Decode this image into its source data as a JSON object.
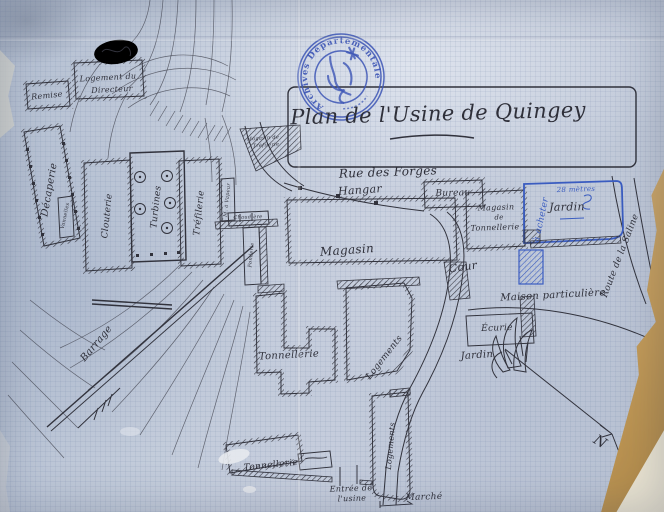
{
  "stamp": {
    "text": "Archives Départementales",
    "color": "#3c55b5"
  },
  "palette": {
    "paper": "#bfc8d7",
    "ink": "#31323c",
    "blue_ink": "#3a5cc0",
    "stamp_blue": "#3c55b5",
    "tear_tan": "#c9a567",
    "fold_cream": "#e9e3d1"
  },
  "labels": [
    {
      "n": "map-title",
      "t": "Plan de l'Usine de Quingey",
      "x": 438,
      "y": 114,
      "r": -1.5,
      "s": 21
    },
    {
      "n": "label-rue-des-forges",
      "t": "Rue des Forges",
      "x": 388,
      "y": 172,
      "r": -2,
      "s": 12
    },
    {
      "n": "label-hangar",
      "t": "Hangar",
      "x": 360,
      "y": 190,
      "r": -4,
      "s": 11
    },
    {
      "n": "label-bureau",
      "t": "Bureau",
      "x": 453,
      "y": 194,
      "r": -1,
      "s": 9
    },
    {
      "n": "label-magasin-tonnellerie-1",
      "t": "Magasin",
      "x": 496,
      "y": 208,
      "r": -2,
      "s": 8
    },
    {
      "n": "label-magasin-tonnellerie-2",
      "t": "de",
      "x": 499,
      "y": 218,
      "r": -2,
      "s": 7
    },
    {
      "n": "label-magasin-tonnellerie-3",
      "t": "Tonnellerie",
      "x": 495,
      "y": 228,
      "r": -2,
      "s": 8
    },
    {
      "n": "label-jardin-nord",
      "t": "Jardin",
      "x": 567,
      "y": 207,
      "r": -1,
      "s": 11
    },
    {
      "n": "label-dimension-jardin",
      "t": "28 mètres",
      "x": 576,
      "y": 190,
      "r": -2,
      "s": 7,
      "c": "blue"
    },
    {
      "n": "label-a-acheter",
      "t": "à acheter",
      "x": 542,
      "y": 220,
      "r": -78,
      "s": 9,
      "c": "blue"
    },
    {
      "n": "label-route-de-la-saline",
      "t": "Route de la Saline",
      "x": 621,
      "y": 256,
      "r": -69,
      "s": 9
    },
    {
      "n": "label-maison-particuliere",
      "t": "Maison particulière",
      "x": 553,
      "y": 296,
      "r": -3,
      "s": 10
    },
    {
      "n": "label-cour",
      "t": "Cour",
      "x": 463,
      "y": 267,
      "r": -8,
      "s": 11
    },
    {
      "n": "label-magasin",
      "t": "Magasin",
      "x": 347,
      "y": 250,
      "r": -4,
      "s": 12
    },
    {
      "n": "label-tonnellerie-centre",
      "t": "Tonnellerie",
      "x": 289,
      "y": 356,
      "r": -3,
      "s": 10
    },
    {
      "n": "label-logements-centre",
      "t": "Logements",
      "x": 385,
      "y": 358,
      "r": -52,
      "s": 9
    },
    {
      "n": "label-ecurie",
      "t": "Écurie",
      "x": 497,
      "y": 329,
      "r": -2,
      "s": 9
    },
    {
      "n": "label-jardin-sud",
      "t": "Jardin",
      "x": 477,
      "y": 356,
      "r": -4,
      "s": 10
    },
    {
      "n": "label-nord",
      "t": "N",
      "x": 600,
      "y": 442,
      "r": 32,
      "s": 14
    },
    {
      "n": "label-logements-sud",
      "t": "Logements",
      "x": 391,
      "y": 446,
      "r": -85,
      "s": 8
    },
    {
      "n": "label-tonnellerie-sud",
      "t": "Tonnellerie",
      "x": 271,
      "y": 466,
      "r": -6,
      "s": 9
    },
    {
      "n": "label-entree-usine-1",
      "t": "Entrée de",
      "x": 351,
      "y": 489,
      "r": -2,
      "s": 8
    },
    {
      "n": "label-entree-usine-2",
      "t": "l'usine",
      "x": 352,
      "y": 499,
      "r": -2,
      "s": 8
    },
    {
      "n": "label-marche",
      "t": "Marché",
      "x": 424,
      "y": 498,
      "r": -2,
      "s": 9
    },
    {
      "n": "label-remise",
      "t": "Remise",
      "x": 47,
      "y": 96,
      "r": -6,
      "s": 8
    },
    {
      "n": "label-logement-directeur-1",
      "t": "Logement du",
      "x": 108,
      "y": 78,
      "r": -3,
      "s": 8
    },
    {
      "n": "label-logement-directeur-2",
      "t": "Directeur",
      "x": 112,
      "y": 90,
      "r": -3,
      "s": 8
    },
    {
      "n": "label-decaperie",
      "t": "Décaperie",
      "x": 50,
      "y": 190,
      "r": -80,
      "s": 10
    },
    {
      "n": "label-clouterie",
      "t": "Clouterie",
      "x": 108,
      "y": 216,
      "r": -84,
      "s": 9
    },
    {
      "n": "label-turbines",
      "t": "Turbines",
      "x": 157,
      "y": 207,
      "r": -84,
      "s": 9
    },
    {
      "n": "label-trefilerie",
      "t": "Tréfilerie",
      "x": 200,
      "y": 213,
      "r": -84,
      "s": 9
    },
    {
      "n": "label-machine-a-vapeur",
      "t": "M. à Vapeur",
      "x": 228,
      "y": 200,
      "r": -84,
      "s": 5
    },
    {
      "n": "label-magasin-trefilerie-1",
      "t": "Magasin de",
      "x": 263,
      "y": 139,
      "r": -4,
      "s": 5
    },
    {
      "n": "label-magasin-trefilerie-2",
      "t": "Tréfilerie",
      "x": 266,
      "y": 146,
      "r": -4,
      "s": 5
    },
    {
      "n": "label-chaudiere",
      "t": "Chaudière",
      "x": 248,
      "y": 218,
      "r": -2,
      "s": 5
    },
    {
      "n": "label-fonderie",
      "t": "Fonderie",
      "x": 252,
      "y": 255,
      "r": -84,
      "s": 5
    },
    {
      "n": "label-vannelles",
      "t": "Vannelles",
      "x": 66,
      "y": 216,
      "r": -78,
      "s": 5
    },
    {
      "n": "label-barrage",
      "t": "Barrage",
      "x": 97,
      "y": 344,
      "r": -50,
      "s": 10
    }
  ]
}
